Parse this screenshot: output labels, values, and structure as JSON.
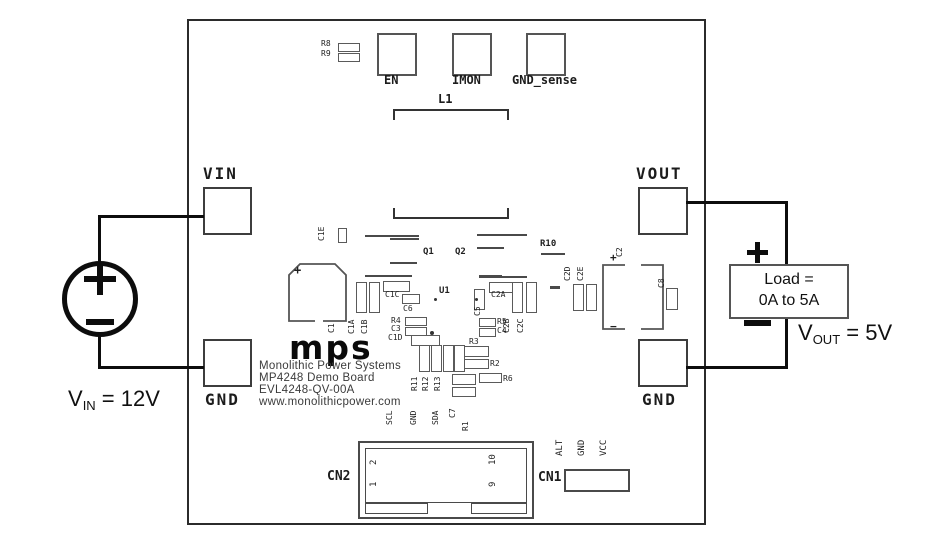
{
  "external": {
    "vin_sym": "V",
    "vin_sub": "IN",
    "vin_rest": " = 12V",
    "vout_sym": "V",
    "vout_sub": "OUT",
    "vout_rest": " = 5V",
    "load_line1": "Load =",
    "load_line2": "0A to 5A",
    "symbols": {
      "source_plus": "plus",
      "source_minus": "minus",
      "load_plus": "plus",
      "load_minus": "minus"
    }
  },
  "board": {
    "pads": {
      "vin": "VIN",
      "gnd_left": "GND",
      "vout": "VOUT",
      "gnd_right": "GND",
      "en": "EN",
      "imon": "IMON",
      "gnd_sense": "GND_sense",
      "l1": "L1"
    },
    "logo_text": "mps",
    "logo_lines": {
      "l1": "Monolithic Power Systems",
      "l2": "MP4248 Demo Board",
      "l3": "EVL4248-QV-00A",
      "l4": "www.monolithicpower.com"
    },
    "connectors": {
      "cn2": "CN2",
      "cn1": "CN1",
      "pin1": "1",
      "pin2": "2",
      "pin9": "9",
      "pin10": "10",
      "scl": "SCL",
      "gnd": "GND",
      "sda": "SDA",
      "alt": "ALT",
      "gnd2": "GND",
      "vcc": "VCC"
    },
    "silkscreen": [
      {
        "name": "refdes-r8",
        "text": "R8",
        "x": 132,
        "y": 18
      },
      {
        "name": "refdes-r9",
        "text": "R9",
        "x": 132,
        "y": 28
      },
      {
        "name": "refdes-c1e",
        "text": "C1E",
        "x": 138,
        "y": 210,
        "rot": true
      },
      {
        "name": "refdes-q1",
        "text": "Q1",
        "x": 234,
        "y": 226,
        "size": 9,
        "bold": true
      },
      {
        "name": "refdes-q2",
        "text": "Q2",
        "x": 266,
        "y": 226,
        "size": 9,
        "bold": true
      },
      {
        "name": "refdes-r10",
        "text": "R10",
        "x": 351,
        "y": 218,
        "size": 9,
        "bold": true
      },
      {
        "name": "refdes-u1",
        "text": "U1",
        "x": 250,
        "y": 265,
        "size": 9,
        "bold": true
      },
      {
        "name": "refdes-c1",
        "text": "C1",
        "x": 148,
        "y": 302,
        "rot": true
      },
      {
        "name": "refdes-c1a",
        "text": "C1A",
        "x": 168,
        "y": 303,
        "rot": true
      },
      {
        "name": "refdes-c1b",
        "text": "C1B",
        "x": 181,
        "y": 303,
        "rot": true
      },
      {
        "name": "refdes-c1c",
        "text": "C1C",
        "x": 196,
        "y": 269
      },
      {
        "name": "refdes-c6",
        "text": "C6",
        "x": 214,
        "y": 283
      },
      {
        "name": "refdes-r4",
        "text": "R4",
        "x": 202,
        "y": 295
      },
      {
        "name": "refdes-c3",
        "text": "C3",
        "x": 202,
        "y": 303
      },
      {
        "name": "refdes-c1d",
        "text": "C1D",
        "x": 199,
        "y": 312
      },
      {
        "name": "refdes-c5",
        "text": "C5",
        "x": 294,
        "y": 285,
        "rot": true
      },
      {
        "name": "refdes-c2a",
        "text": "C2A",
        "x": 302,
        "y": 269
      },
      {
        "name": "refdes-c2b",
        "text": "C2B",
        "x": 323,
        "y": 302,
        "rot": true
      },
      {
        "name": "refdes-c2c",
        "text": "C2C",
        "x": 337,
        "y": 302,
        "rot": true
      },
      {
        "name": "refdes-r5",
        "text": "R5",
        "x": 308,
        "y": 296
      },
      {
        "name": "refdes-c4",
        "text": "C4",
        "x": 308,
        "y": 305
      },
      {
        "name": "refdes-r3",
        "text": "R3",
        "x": 280,
        "y": 316
      },
      {
        "name": "refdes-r2",
        "text": "R2",
        "x": 301,
        "y": 338
      },
      {
        "name": "refdes-r11",
        "text": "R11",
        "x": 231,
        "y": 360,
        "rot": true
      },
      {
        "name": "refdes-r12",
        "text": "R12",
        "x": 242,
        "y": 360,
        "rot": true
      },
      {
        "name": "refdes-r13",
        "text": "R13",
        "x": 254,
        "y": 360,
        "rot": true
      },
      {
        "name": "refdes-r6",
        "text": "R6",
        "x": 314,
        "y": 353
      },
      {
        "name": "refdes-c7",
        "text": "C7",
        "x": 269,
        "y": 387,
        "rot": true
      },
      {
        "name": "refdes-r1",
        "text": "R1",
        "x": 282,
        "y": 400,
        "rot": true
      },
      {
        "name": "refdes-c2d",
        "text": "C2D",
        "x": 384,
        "y": 250,
        "rot": true
      },
      {
        "name": "refdes-c2e",
        "text": "C2E",
        "x": 397,
        "y": 250,
        "rot": true
      },
      {
        "name": "refdes-c2",
        "text": "C2",
        "x": 436,
        "y": 226,
        "rot": true
      },
      {
        "name": "refdes-c8",
        "text": "C8",
        "x": 478,
        "y": 257,
        "rot": true
      },
      {
        "name": "c1-plus-mark",
        "text": "+",
        "x": 105,
        "y": 244,
        "size": 12,
        "bold": true
      },
      {
        "name": "c2-plus-mark",
        "text": "+",
        "x": 421,
        "y": 232,
        "size": 11,
        "bold": true
      },
      {
        "name": "c2-minus-mark",
        "text": "−",
        "x": 421,
        "y": 301,
        "size": 11,
        "bold": true
      }
    ],
    "parts": [
      {
        "name": "r8-body",
        "x": 149,
        "y": 22,
        "w": 22,
        "h": 9
      },
      {
        "name": "r9-body",
        "x": 149,
        "y": 32,
        "w": 22,
        "h": 9
      },
      {
        "name": "c1e-body",
        "x": 149,
        "y": 207,
        "w": 9,
        "h": 15
      },
      {
        "name": "c1a-body",
        "x": 167,
        "y": 261,
        "w": 11,
        "h": 31
      },
      {
        "name": "c1b-body",
        "x": 180,
        "y": 261,
        "w": 11,
        "h": 31
      },
      {
        "name": "c1c-body",
        "x": 194,
        "y": 260,
        "w": 27,
        "h": 11
      },
      {
        "name": "c6-body",
        "x": 213,
        "y": 273,
        "w": 18,
        "h": 10
      },
      {
        "name": "r4-body",
        "x": 216,
        "y": 296,
        "w": 22,
        "h": 9
      },
      {
        "name": "c3-body",
        "x": 216,
        "y": 306,
        "w": 22,
        "h": 9
      },
      {
        "name": "c1d-body",
        "x": 222,
        "y": 314,
        "w": 29,
        "h": 11
      },
      {
        "name": "c5-body",
        "x": 285,
        "y": 268,
        "w": 11,
        "h": 21
      },
      {
        "name": "c2a-body",
        "x": 300,
        "y": 261,
        "w": 26,
        "h": 11
      },
      {
        "name": "c2b-body",
        "x": 323,
        "y": 261,
        "w": 11,
        "h": 31
      },
      {
        "name": "c2c-body",
        "x": 337,
        "y": 261,
        "w": 11,
        "h": 31
      },
      {
        "name": "r5-body-1",
        "x": 290,
        "y": 297,
        "w": 17,
        "h": 9
      },
      {
        "name": "r5-body-2",
        "x": 290,
        "y": 307,
        "w": 17,
        "h": 9
      },
      {
        "name": "r3-body",
        "x": 275,
        "y": 325,
        "w": 25,
        "h": 11
      },
      {
        "name": "r2-body",
        "x": 275,
        "y": 338,
        "w": 25,
        "h": 10
      },
      {
        "name": "r11-body",
        "x": 230,
        "y": 324,
        "w": 11,
        "h": 27
      },
      {
        "name": "r12-body",
        "x": 242,
        "y": 324,
        "w": 11,
        "h": 27
      },
      {
        "name": "r13-body",
        "x": 254,
        "y": 324,
        "w": 11,
        "h": 27
      },
      {
        "name": "r14-body",
        "x": 265,
        "y": 324,
        "w": 11,
        "h": 27
      },
      {
        "name": "c7-body",
        "x": 263,
        "y": 353,
        "w": 24,
        "h": 11
      },
      {
        "name": "r1-body",
        "x": 263,
        "y": 366,
        "w": 24,
        "h": 10
      },
      {
        "name": "r6-body",
        "x": 290,
        "y": 352,
        "w": 23,
        "h": 10
      },
      {
        "name": "c2d-body",
        "x": 384,
        "y": 263,
        "w": 11,
        "h": 27
      },
      {
        "name": "c2e-body",
        "x": 397,
        "y": 263,
        "w": 11,
        "h": 27
      },
      {
        "name": "c8-body",
        "x": 477,
        "y": 267,
        "w": 12,
        "h": 22
      }
    ],
    "traces": [
      {
        "x": 176,
        "y": 214,
        "w": 54,
        "h": 2
      },
      {
        "x": 201,
        "y": 217,
        "w": 29,
        "h": 2
      },
      {
        "x": 288,
        "y": 213,
        "w": 50,
        "h": 2
      },
      {
        "x": 288,
        "y": 226,
        "w": 27,
        "h": 2
      },
      {
        "x": 201,
        "y": 241,
        "w": 27,
        "h": 2
      },
      {
        "x": 176,
        "y": 254,
        "w": 47,
        "h": 2
      },
      {
        "x": 290,
        "y": 254,
        "w": 23,
        "h": 3
      },
      {
        "x": 313,
        "y": 255,
        "w": 25,
        "h": 2
      },
      {
        "x": 352,
        "y": 232,
        "w": 24,
        "h": 2
      },
      {
        "x": 361,
        "y": 265,
        "w": 10,
        "h": 3
      }
    ],
    "dots": [
      {
        "x": 245,
        "y": 277,
        "w": 3,
        "h": 3
      },
      {
        "x": 286,
        "y": 277,
        "w": 3,
        "h": 3
      },
      {
        "x": 241,
        "y": 310,
        "w": 4,
        "h": 4
      }
    ]
  }
}
